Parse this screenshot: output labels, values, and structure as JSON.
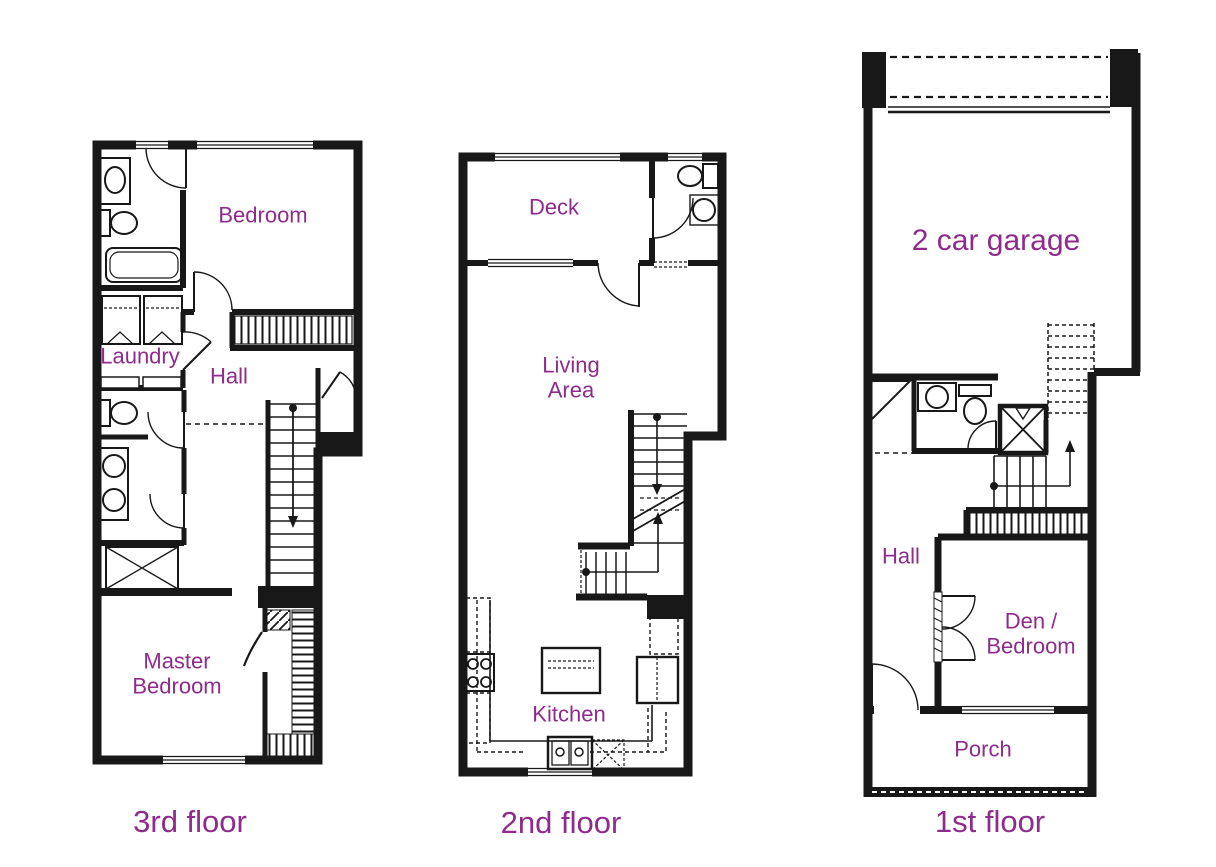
{
  "palette": {
    "label_color": "#8f2b8d",
    "wall_color": "#181818",
    "background": "#ffffff"
  },
  "floors": [
    {
      "name": "3rd-floor",
      "caption": "3rd floor",
      "rooms": [
        {
          "name": "bedroom",
          "label": "Bedroom"
        },
        {
          "name": "laundry",
          "label": "Laundry"
        },
        {
          "name": "hall",
          "label": "Hall"
        },
        {
          "name": "master-bedroom",
          "label": "Master Bedroom"
        }
      ],
      "fixtures": [
        "sink-vanity",
        "toilet",
        "bathtub",
        "washer",
        "dryer",
        "second-toilet",
        "double-sink-vanity",
        "linen-closet",
        "stairs-down",
        "bedroom-closet",
        "walk-in-closet"
      ]
    },
    {
      "name": "2nd-floor",
      "caption": "2nd floor",
      "rooms": [
        {
          "name": "deck",
          "label": "Deck"
        },
        {
          "name": "living-area",
          "label": "Living Area"
        },
        {
          "name": "kitchen",
          "label": "Kitchen"
        }
      ],
      "fixtures": [
        "toilet",
        "round-sink",
        "stairs-up-down",
        "landing-rail",
        "range-4-burner",
        "kitchen-island",
        "double-sink",
        "dishwasher",
        "refrigerator",
        "counters"
      ]
    },
    {
      "name": "1st-floor",
      "caption": "1st floor",
      "rooms": [
        {
          "name": "garage",
          "label": "2 car garage"
        },
        {
          "name": "hall",
          "label": "Hall"
        },
        {
          "name": "den-bedroom",
          "label": "Den / Bedroom"
        },
        {
          "name": "porch",
          "label": "Porch"
        }
      ],
      "fixtures": [
        "garage-door",
        "coat-closet",
        "sink-vanity",
        "toilet",
        "shower",
        "stairs-up",
        "hall-closet",
        "french-doors",
        "entry-door"
      ]
    }
  ]
}
